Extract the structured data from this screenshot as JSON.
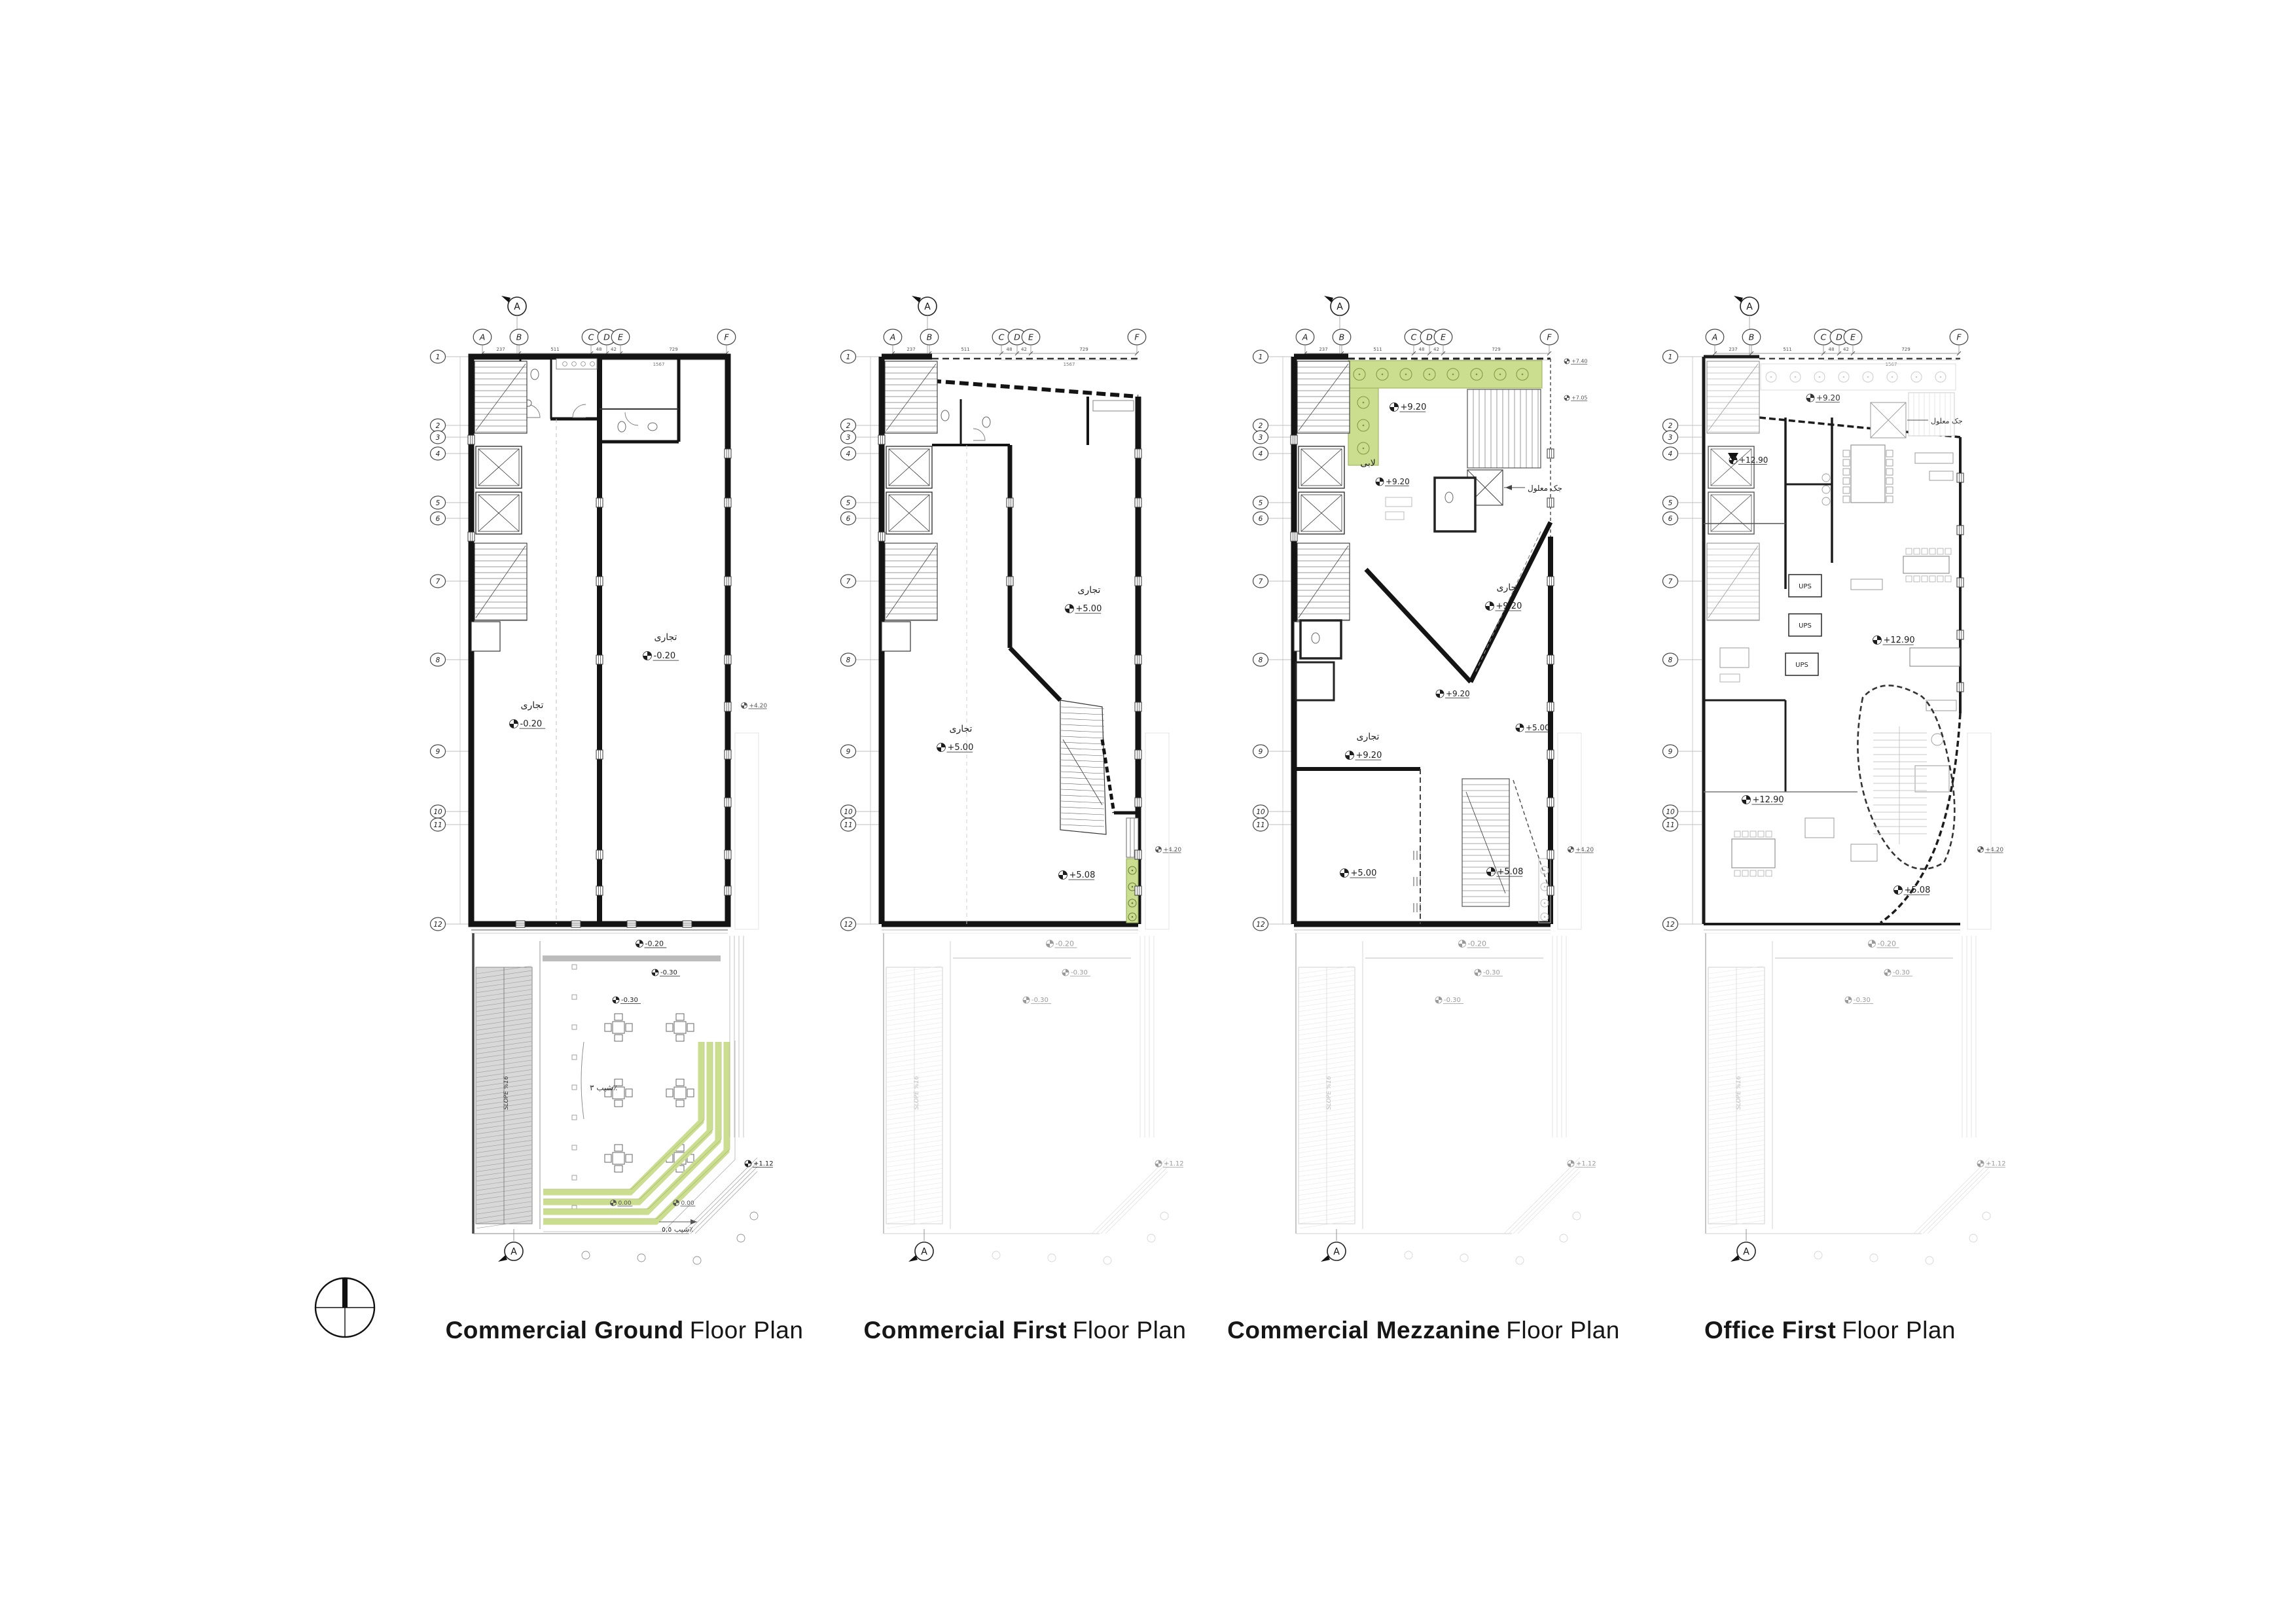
{
  "document": {
    "background": "#ffffff",
    "type": "architectural floor plan sheet"
  },
  "colors": {
    "wall": "#141414",
    "medium_line": "#555555",
    "light_line": "#aaaaaa",
    "faint_line": "#cccccc",
    "green_fill": "#cbdd8f",
    "green_edge": "#8fa857",
    "ramp_gray": "#d8d8d8",
    "band_gray": "#bcbcbc"
  },
  "section_marker_letter": "A",
  "grid": {
    "columns": [
      "A",
      "B",
      "C",
      "D",
      "E",
      "F"
    ],
    "rows": [
      "1",
      "2",
      "3",
      "4",
      "5",
      "6",
      "7",
      "8",
      "9",
      "10",
      "11",
      "12"
    ],
    "top_dimensions": [
      "237",
      "511",
      "48",
      "42",
      "1567",
      "729"
    ]
  },
  "shared_annotations": {
    "slope_ramp": "SLOPE %16",
    "below_building_level": "-0.20",
    "site_level_1": "-0.30",
    "site_level_2": "-0.30",
    "site_level_3": "+1.12",
    "zero_level": "0.00"
  },
  "plans": [
    {
      "id": "ground",
      "title_bold": "Commercial Ground",
      "title_regular": "Floor Plan",
      "rooms": [
        {
          "name": "تجاری",
          "level": "-0.20"
        },
        {
          "name": "تجاری",
          "level": "-0.20"
        }
      ],
      "site": {
        "slope_courtyard": "شیب ٣٪",
        "slope_corner": "شیب ٥,٥٪"
      },
      "right_level": "+4.20"
    },
    {
      "id": "first",
      "title_bold": "Commercial First",
      "title_regular": "Floor Plan",
      "rooms": [
        {
          "name": "تجاری",
          "level": "+5.00"
        },
        {
          "name": "تجاری",
          "level": "+5.00"
        }
      ],
      "levels": [
        "+5.08"
      ],
      "right_level": "+4.20"
    },
    {
      "id": "mezzanine",
      "title_bold": "Commercial Mezzanine",
      "title_regular": "Floor Plan",
      "rooms": [
        {
          "name": "لابی",
          "level": "+9.20"
        },
        {
          "name": "تجاری",
          "level": "+9.20"
        },
        {
          "name": "تجاری",
          "level": "+9.20"
        }
      ],
      "levels": [
        "+9.20",
        "+9.20",
        "+5.00",
        "+5.00",
        "+5.08"
      ],
      "upper_levels": [
        "+7.40",
        "+7.05"
      ],
      "note": "جک معلول",
      "right_level": "+4.20"
    },
    {
      "id": "office",
      "title_bold": "Office First",
      "title_regular": "Floor Plan",
      "levels": [
        "+9.20",
        "+12.90",
        "+12.90",
        "+12.90",
        "+5.08"
      ],
      "ups": "UPS",
      "note": "جک معلول",
      "right_level": "+4.20"
    }
  ]
}
